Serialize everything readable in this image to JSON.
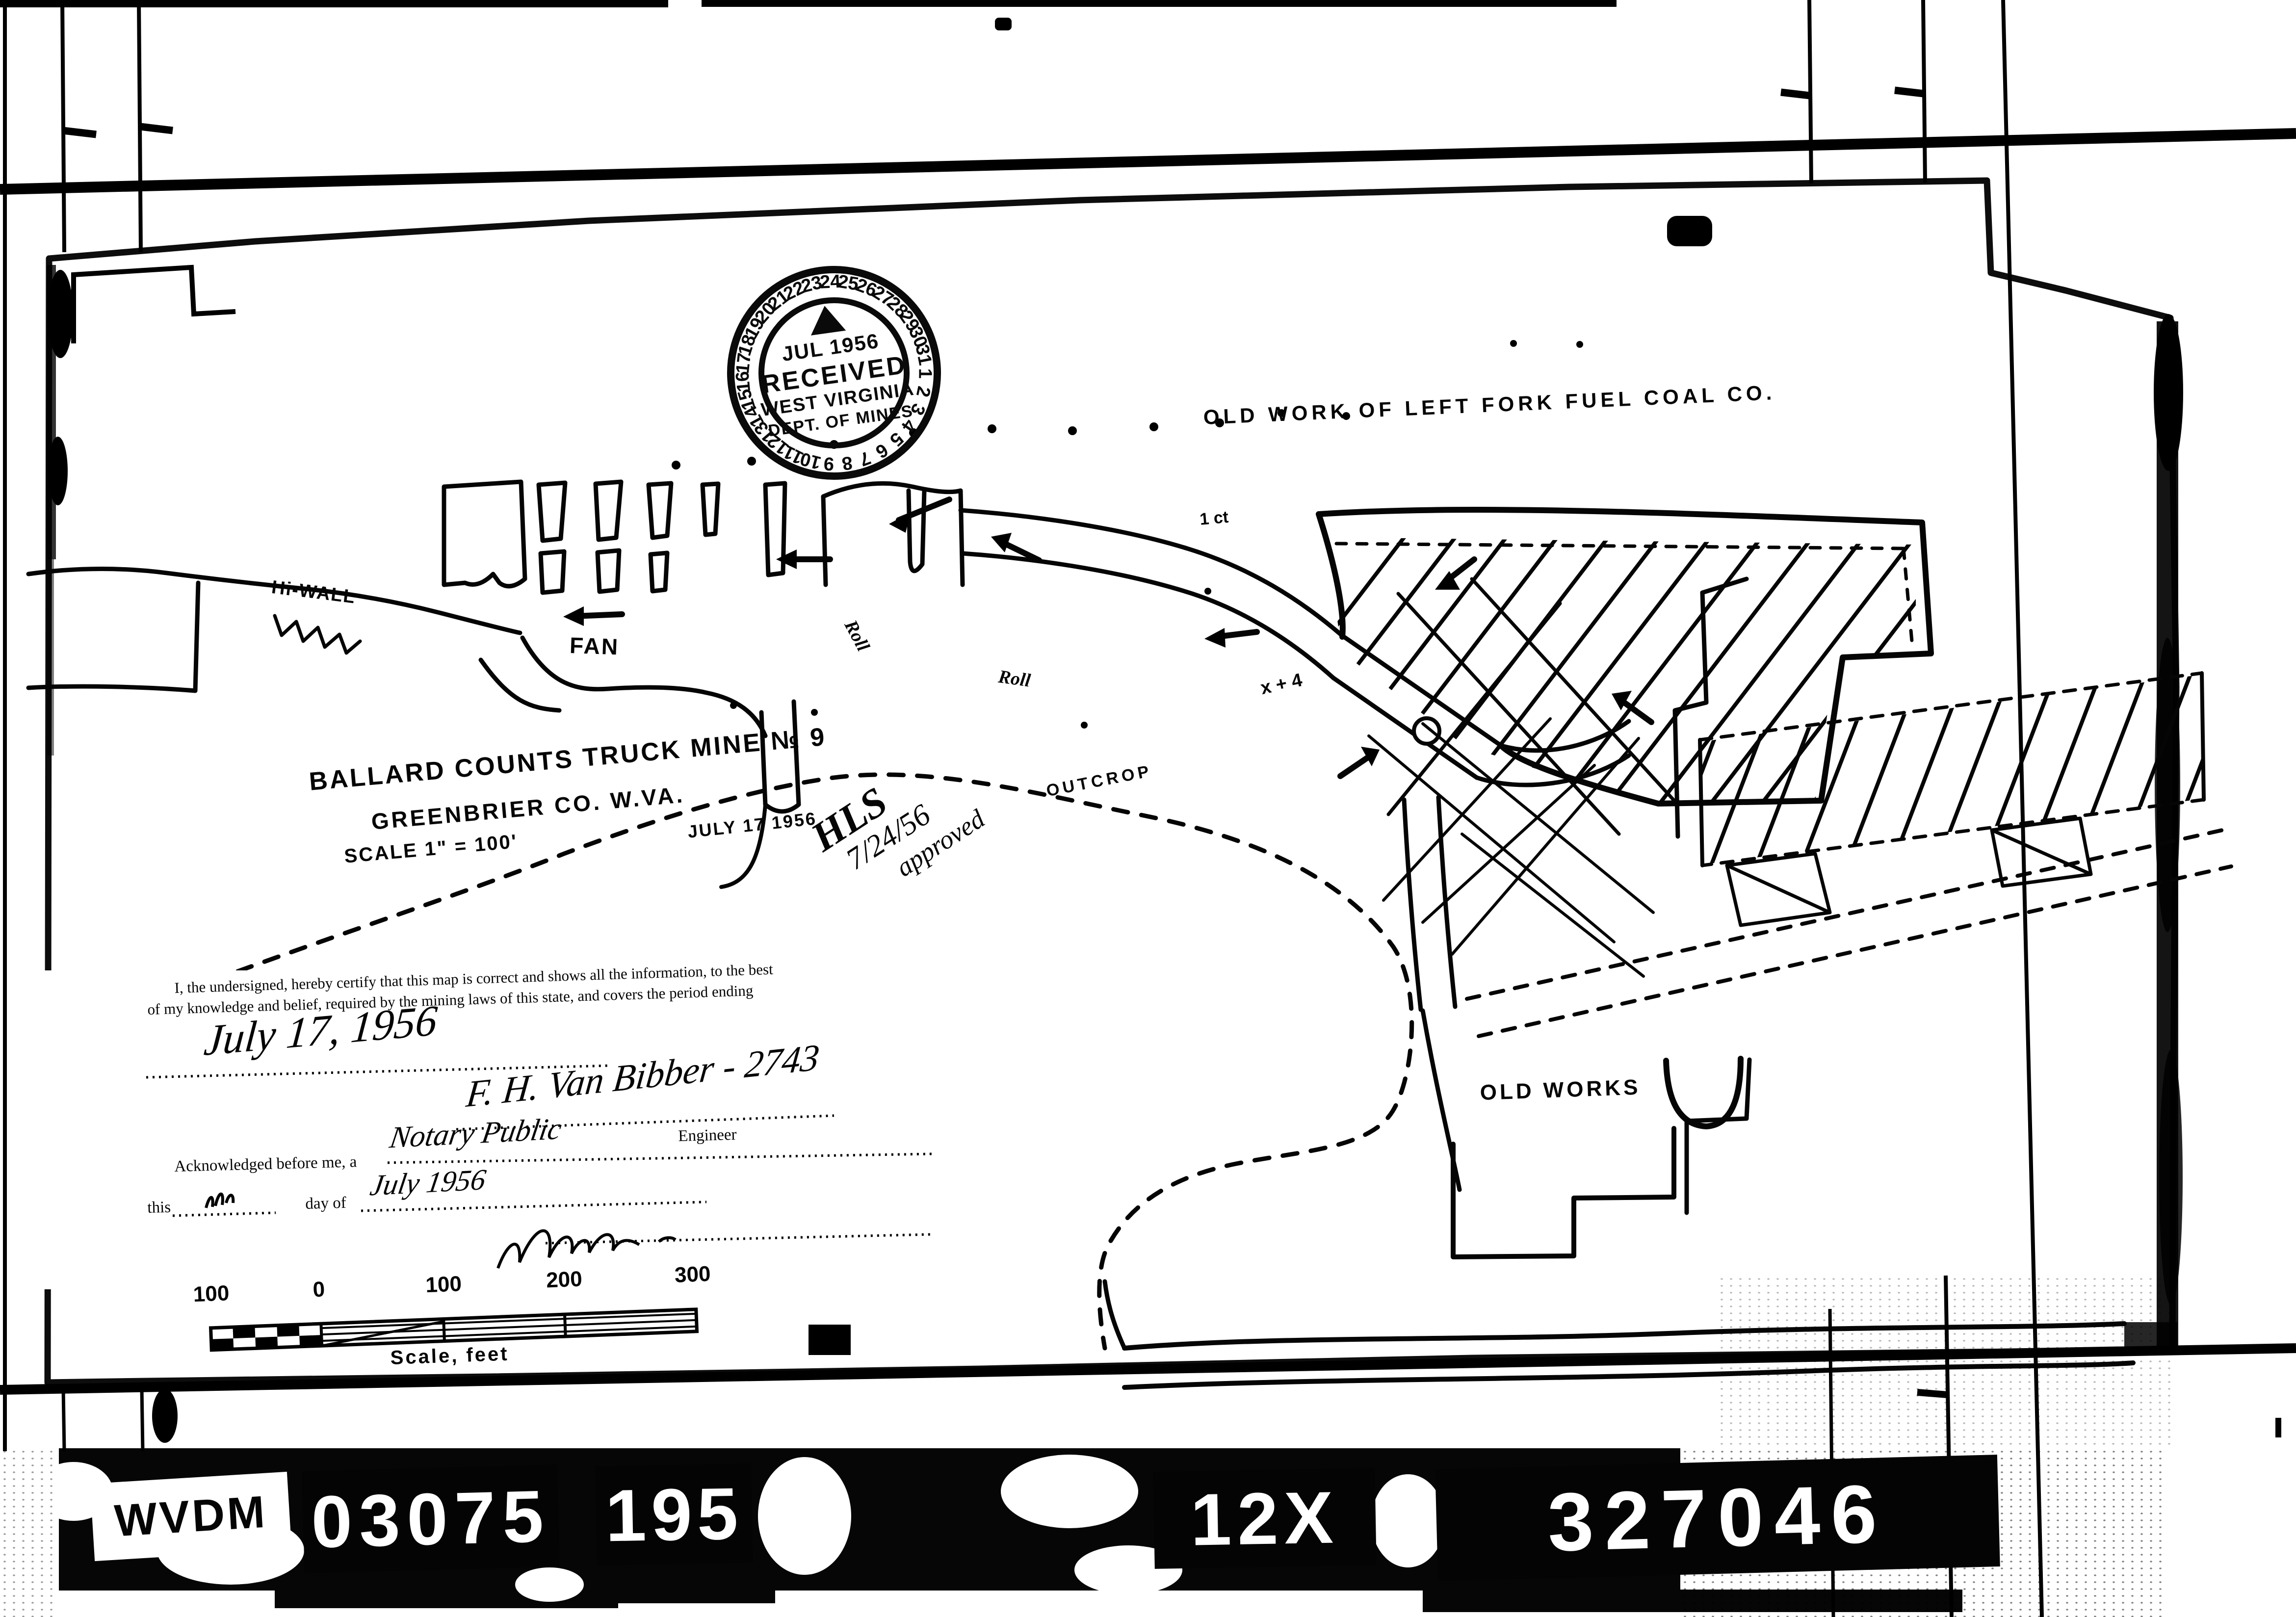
{
  "stamp": {
    "month_year": "JUL 1956",
    "received": "RECEIVED",
    "state": "WEST VIRGINIA",
    "dept": "DEPT. OF MINES",
    "ring_numbers": [
      "1",
      "2",
      "3",
      "4",
      "5",
      "6",
      "7",
      "8",
      "9",
      "10",
      "11",
      "12",
      "13",
      "14",
      "15",
      "16",
      "17",
      "18",
      "19",
      "20",
      "21",
      "22",
      "23",
      "24",
      "25",
      "26",
      "27",
      "28",
      "29",
      "30",
      "31"
    ]
  },
  "map": {
    "old_work_header": "OLD WORK OF LEFT FORK FUEL COAL CO.",
    "title_line1": "BALLARD COUNTS TRUCK MINE № 9",
    "title_line2": "GREENBRIER CO. W.VA.",
    "scale_note": "SCALE 1\" = 100'",
    "date_note": "JULY 17 1956",
    "approval_line1": "HLS",
    "approval_line2": "7/24/56",
    "approval_line3": "approved",
    "labels": {
      "hi_wall": "Hi-WALL",
      "fan": "FAN",
      "roll_upper": "Roll",
      "roll_lower": "Roll",
      "outcrop": "OUTCROP",
      "old_works": "OLD WORKS",
      "entry_mark": "1 ct",
      "survey_mark": "x + 4"
    }
  },
  "certificate": {
    "body_line1": "I, the undersigned, hereby certify that this map is correct and shows all the information, to the best",
    "body_line2": "of my knowledge and belief, required by the mining laws of this state, and covers the period ending",
    "period_ending": "July 17, 1956",
    "signature": "F. H. Van Bibber - 2743",
    "engineer_label": "Engineer",
    "acknowledged_text": "Acknowledged before me, a",
    "officer_title": "Notary Public",
    "this_label": "this",
    "day_of_label": "day of",
    "month_value": "July 1956"
  },
  "scale_bar": {
    "tick_labels": [
      "100",
      "0",
      "100",
      "200",
      "300"
    ],
    "caption": "Scale, feet"
  },
  "film_ids": {
    "archive": "WVDM",
    "reel": "03075",
    "frame": "195",
    "reduction": "12X",
    "document": "327046"
  }
}
